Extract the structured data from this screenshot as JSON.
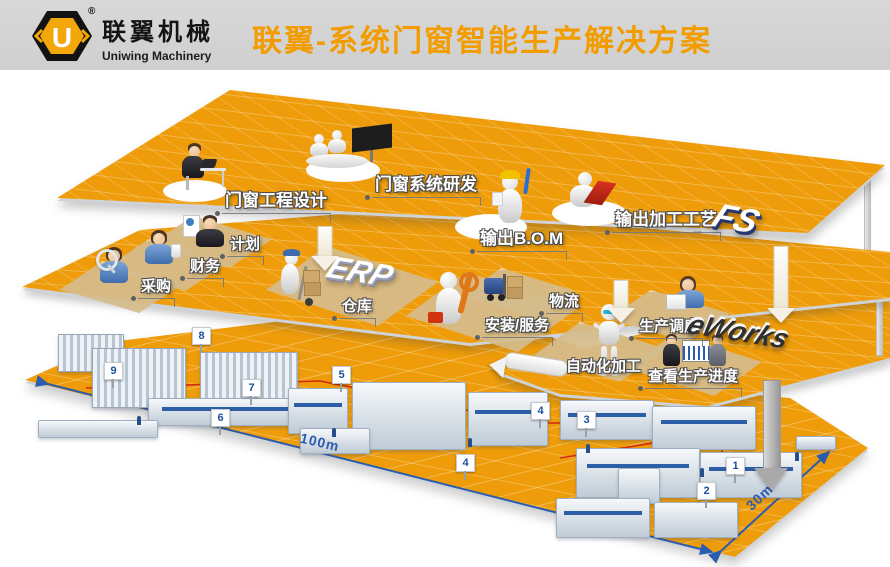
{
  "header": {
    "brand_cn": "联翼机械",
    "brand_en": "Uniwing Machinery",
    "registered_mark": "®",
    "logo_letter": "U",
    "title": "联翼-系统门窗智能生产解决方案"
  },
  "layers": {
    "fs": {
      "badge": "FS",
      "labels": {
        "design": "门窗工程设计",
        "rnd": "门窗系统研发",
        "bom": "输出B.O.M",
        "craft": "输出加工工艺"
      }
    },
    "erp": {
      "badge": "ERP",
      "labels": {
        "plan": "计划",
        "finance": "财务",
        "purchase": "采购",
        "warehouse": "仓库",
        "service": "安装/服务",
        "logistics": "物流"
      }
    },
    "eworks": {
      "badge": "eWorks",
      "labels": {
        "dispatch": "生产调度",
        "auto": "自动化加工",
        "progress": "查看生产进度"
      }
    }
  },
  "factory": {
    "dim_length": "100m",
    "dim_width": "30m",
    "stations": [
      {
        "n": "9",
        "x": 104,
        "y": 362
      },
      {
        "n": "8",
        "x": 192,
        "y": 327
      },
      {
        "n": "7",
        "x": 242,
        "y": 379
      },
      {
        "n": "6",
        "x": 211,
        "y": 409
      },
      {
        "n": "5",
        "x": 332,
        "y": 366
      },
      {
        "n": "4",
        "x": 531,
        "y": 402
      },
      {
        "n": "4",
        "x": 456,
        "y": 454
      },
      {
        "n": "3",
        "x": 577,
        "y": 411
      },
      {
        "n": "1",
        "x": 726,
        "y": 457
      },
      {
        "n": "2",
        "x": 697,
        "y": 482
      }
    ]
  },
  "colors": {
    "platform_orange": "#EE9C09",
    "title_orange": "#F29C00",
    "station_blue": "#1D4F9C",
    "dimension_blue": "#2B5CB0",
    "flow_red": "#D42A10"
  },
  "icons": [
    "engineer-desk-icon",
    "meeting-table-icon",
    "bom-worker-icon",
    "laptop-worker-icon",
    "planner-icon",
    "finance-icon",
    "purchaser-icon",
    "warehouse-worker-icon",
    "installer-icon",
    "forklift-icon",
    "dispatcher-icon",
    "robot-icon",
    "progress-review-icon"
  ]
}
